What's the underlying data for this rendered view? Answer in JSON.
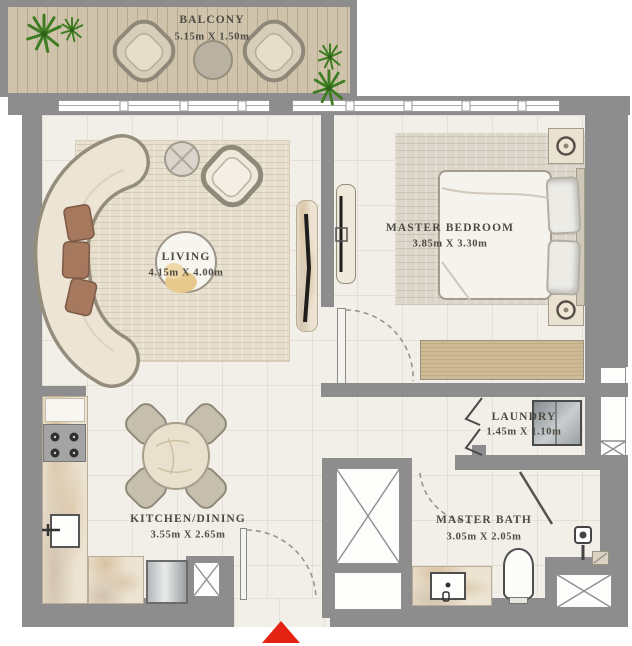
{
  "rooms": {
    "balcony": {
      "label": "BALCONY",
      "dims": "5.15m X 1.50m"
    },
    "living": {
      "label": "LIVING",
      "dims": "4.15m X 4.00m"
    },
    "master_bedroom": {
      "label": "MASTER BEDROOM",
      "dims": "3.85m X 3.30m"
    },
    "laundry": {
      "label": "LAUNDRY",
      "dims": "1.45m X 1.10m"
    },
    "kitchen_dining": {
      "label": "KITCHEN/DINING",
      "dims": "3.55m X 2.65m"
    },
    "master_bath": {
      "label": "MASTER BATH",
      "dims": "3.05m X 2.05m"
    }
  },
  "colors": {
    "wall": "#8d8d8d",
    "floor": "#f2efe9",
    "wood_deck": "#cfc3ac",
    "wardrobe_wood": "#c7b28c",
    "rug": "#e7dfce",
    "marble": "#ece3d2",
    "plant_green": "#3e7d22",
    "entrance_marker_red": "#e42313",
    "label_text": "#4e4b43"
  },
  "markers": {
    "entrance": "entrance-arrow"
  }
}
